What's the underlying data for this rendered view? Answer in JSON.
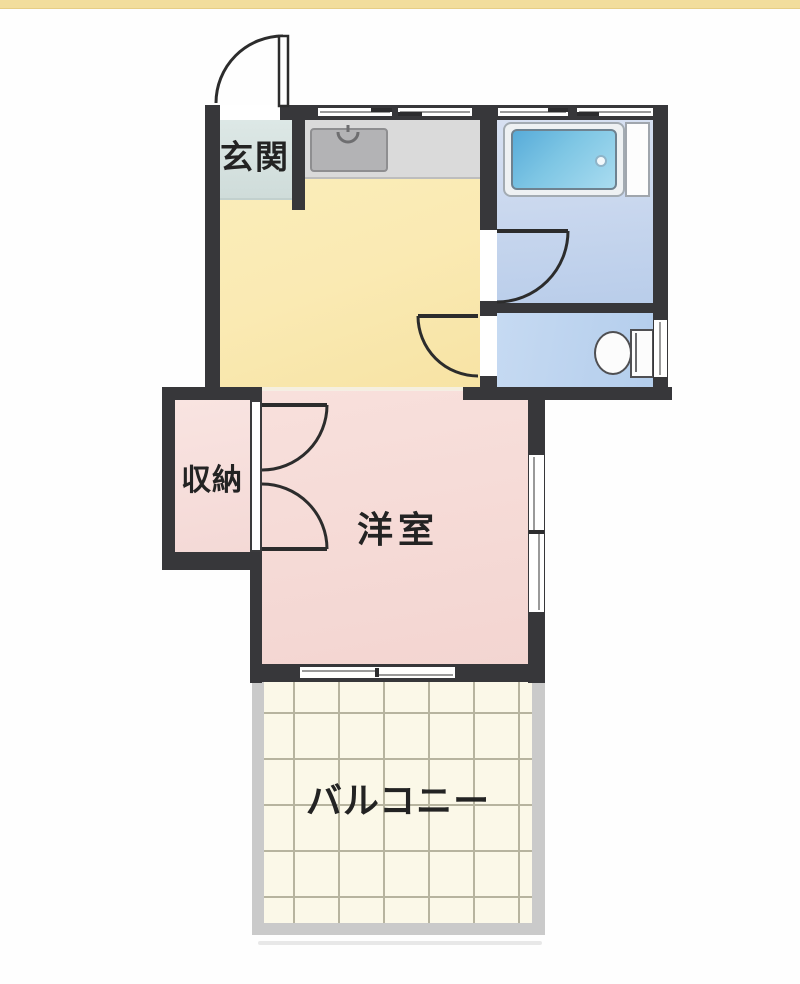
{
  "floorplan": {
    "accent_bar_color": "#f2dd9c",
    "wall_color": "#37373a",
    "door_stroke_color": "#2c2c2c",
    "rooms": {
      "genkan": {
        "label": "玄関",
        "floor_color": "#d9e6e4"
      },
      "kitchen": {
        "floor_color": "#fbecb6"
      },
      "bathroom": {
        "floor_color": "#c8d7ef"
      },
      "toilet": {
        "floor_color": "#bcd3ee"
      },
      "closet": {
        "label": "収納",
        "floor_color": "#f8e2df"
      },
      "western_room": {
        "label": "洋室",
        "floor_color": "#f7dcd8"
      },
      "balcony": {
        "label": "バルコニー",
        "floor_color": "#fbf8e8",
        "grid_color": "#b7b49f",
        "border_color": "#cacaca"
      }
    }
  }
}
